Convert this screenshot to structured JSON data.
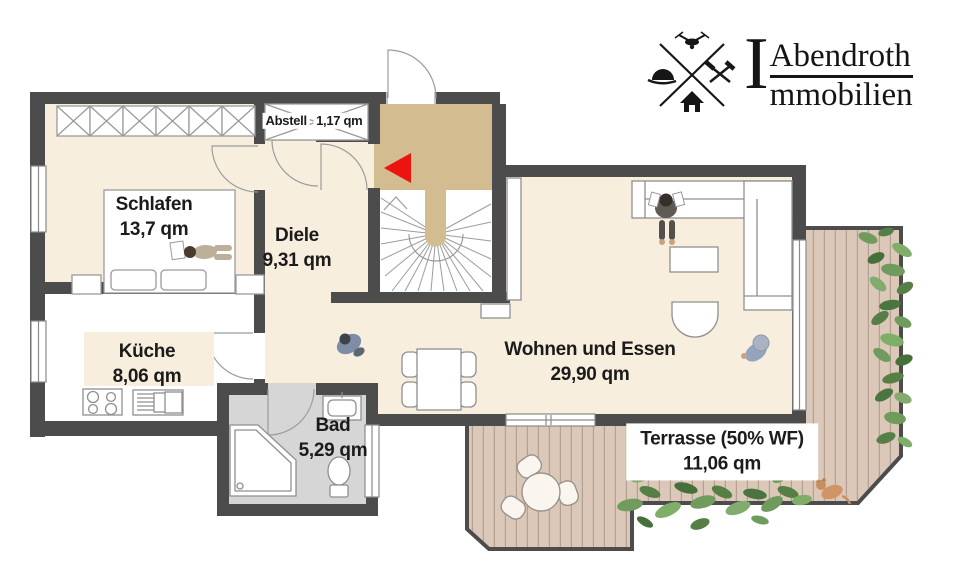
{
  "branding": {
    "initial": "I",
    "line1": "Abendroth",
    "line2": "mmobilien",
    "emblem_icons": [
      "drone-icon",
      "hard-hat-icon",
      "crossed-hammers-icon",
      "house-icon"
    ]
  },
  "rooms": [
    {
      "id": "schlafen",
      "name": "Schlafen",
      "area": "13,7 qm"
    },
    {
      "id": "abstell",
      "name": "Abstell",
      "area": "1,17 qm"
    },
    {
      "id": "diele",
      "name": "Diele",
      "area": "9,31 qm"
    },
    {
      "id": "kueche",
      "name": "Küche",
      "area": "8,06 qm"
    },
    {
      "id": "bad",
      "name": "Bad",
      "area": "5,29 qm"
    },
    {
      "id": "wohnen_essen",
      "name": "Wohnen und Essen",
      "area": "29,90 qm"
    },
    {
      "id": "terrasse",
      "name": "Terrasse (50% WF)",
      "area": "11,06 qm"
    }
  ],
  "plan": {
    "stair_arrow_direction": "left",
    "colors": {
      "floor_cream": "#f8eedd",
      "kitchen_floor": "#ffffff",
      "wall_dark": "#4c4c4c",
      "stair_landing_tan": "#d3bd90",
      "bath_floor_gray": "#d6d6d6",
      "terrace_deck": "#dbc8b9",
      "plank_line": "#b3a092",
      "arrow_red": "#ec1310",
      "plant_green": "#6f9b5d",
      "logo_black": "#151515"
    }
  }
}
